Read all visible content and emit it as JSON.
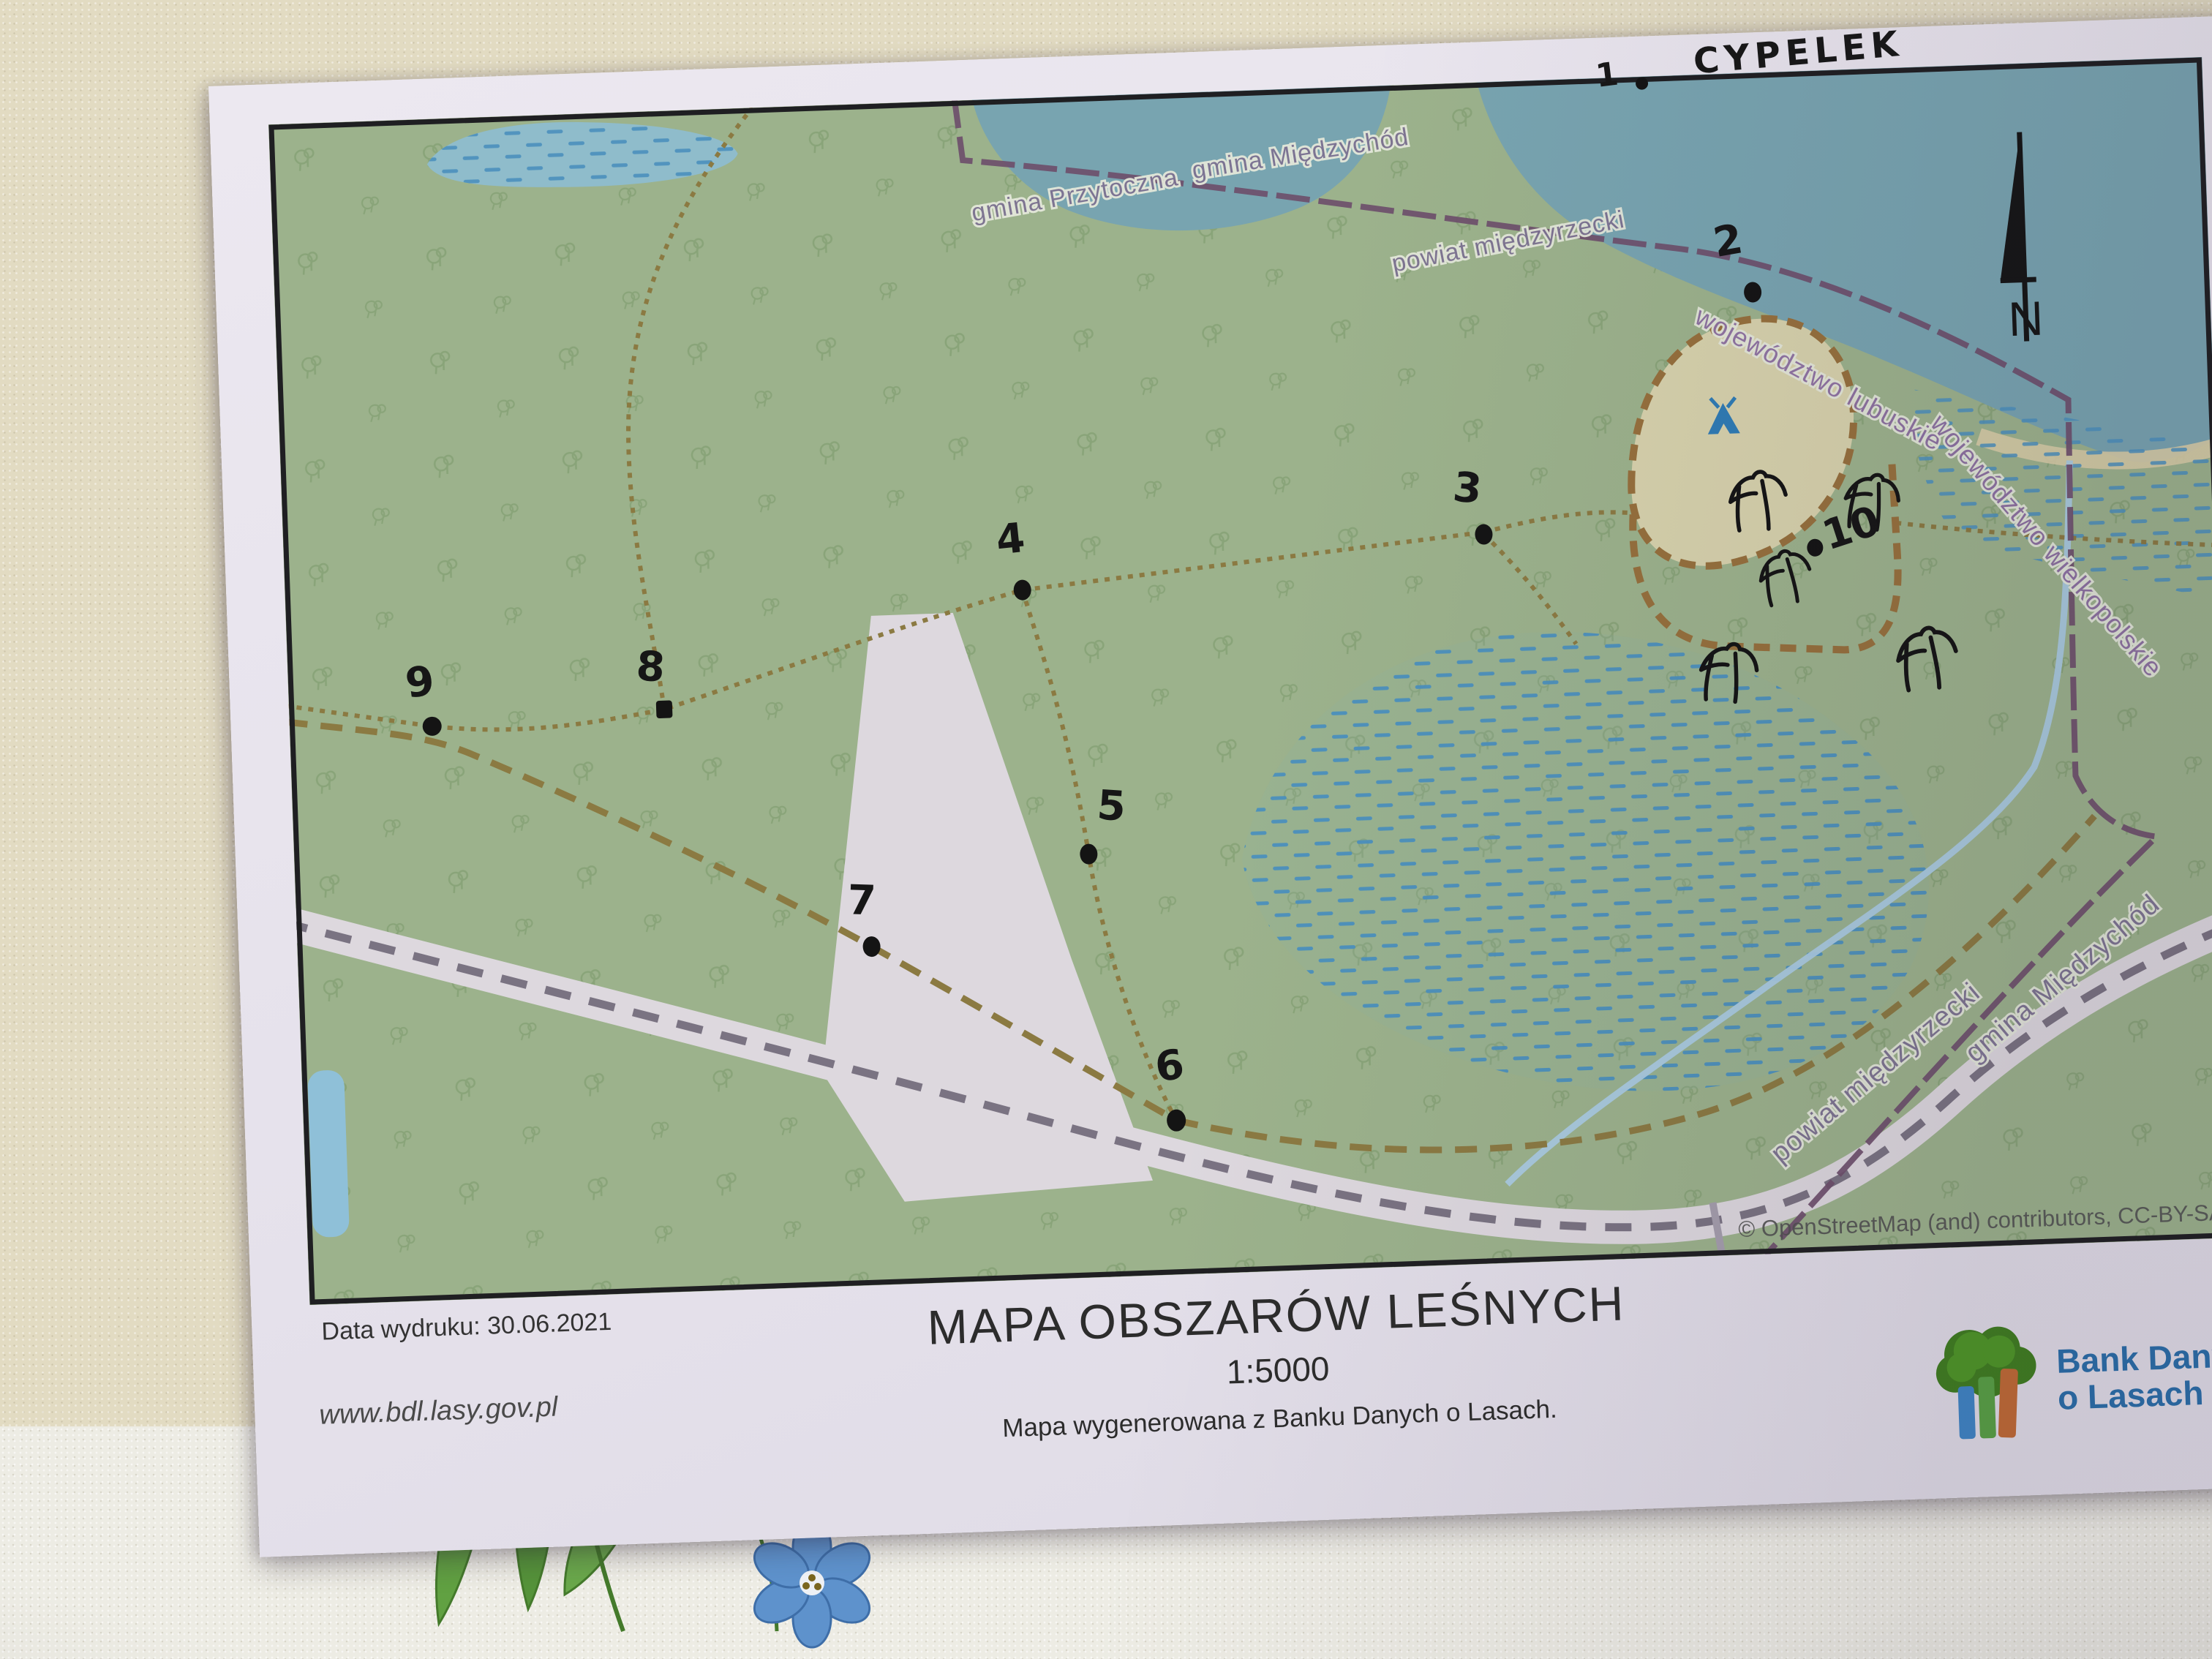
{
  "handwriting": {
    "cypelek": "CYPELEK",
    "n1": "1",
    "n2": "2",
    "n3": "3",
    "n4": "4",
    "n5": "5",
    "n6": "6",
    "n7": "7",
    "n8": "8",
    "n9": "9",
    "n10": "10"
  },
  "map": {
    "admin_labels": {
      "gmina_miedzychod_top": "gmina Międzychód",
      "gmina_przytoczna": "gmina Przytoczna",
      "powiat_miedzyrzecki_top": "powiat międzyrzecki",
      "woj_lubuskie": "województwo lubuskie",
      "woj_wielkopolskie": "województwo wielkopolskie",
      "powiat_miedzyrzecki_bottom": "powiat międzyrzecki",
      "gmina_miedzychod_bottom": "gmina Międzychód"
    },
    "north_label": "N",
    "attribution": "© OpenStreetMap (and) contributors, CC-BY-SA"
  },
  "footer": {
    "print_date": "Data wydruku: 30.06.2021",
    "website": "www.bdl.lasy.gov.pl",
    "title": "MAPA OBSZARÓW LEŚNYCH",
    "scale": "1:5000",
    "subtitle": "Mapa wygenerowana z Banku Danych o Lasach.",
    "logo_line1": "Bank Danych",
    "logo_line2": "o Lasach"
  },
  "colors": {
    "forest_green": "#9cb28c",
    "water_teal": "#78a4b0",
    "marsh_blue": "#4b90bd",
    "trail_olive": "#8b7a42",
    "boundary_purple": "#6e4f6b",
    "clearing_beige": "#d7d2ac",
    "railway_band": "#ddd8de",
    "campsite_blue": "#2f7cb5",
    "logo_blue": "#2a6da8",
    "handwriting_black": "#1a1a1a"
  }
}
